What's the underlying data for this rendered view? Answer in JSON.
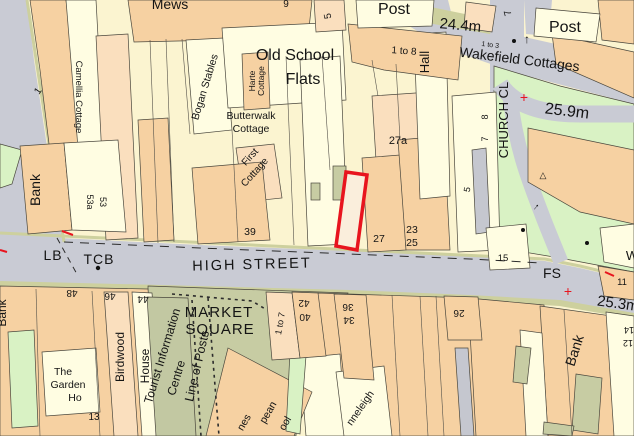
{
  "map": {
    "road_labels": {
      "high_street": "HIGH STREET",
      "church_close": "CHURCH CL"
    },
    "street_furniture": {
      "lb": "LB",
      "tcb": "TCB",
      "fs": "FS",
      "post_left": "Post",
      "post_right": "Post",
      "line_of_posts": "Line of Posts",
      "market_line1": "MARKET",
      "market_line2": "SQUARE"
    },
    "spot_heights": {
      "h244": "24.4m",
      "h259": "25.9m",
      "h253": "25.3m"
    },
    "buildings": {
      "mews": "Mews",
      "old_school_line1": "Old School",
      "old_school_line2": "Flats",
      "wakefield": "Wakefield Cottages",
      "hall": "Hall",
      "camellia": "Camellia Cottage",
      "bogan": "Bogan Stables",
      "harte_line1": "Harte",
      "harte_line2": "Cottage",
      "butterwalk_line1": "Butterwalk",
      "butterwalk_line2": "Cottage",
      "first_line1": "First",
      "first_line2": "Cottage",
      "bank_nw": "Bank",
      "bank_sw": "Bank",
      "bank_se": "Bank",
      "birdwood_line1": "Birdwood",
      "birdwood_line2": "House",
      "tic_line1": "Tourist Information",
      "tic_line2": "Centre",
      "garden_line1": "The",
      "garden_line2": "Garden",
      "garden_line3": "Ho",
      "anneleigh_partial": "nneleigh",
      "school_frag1": "nes",
      "school_frag2": "pean",
      "school_frag3": "ool",
      "w_partial": "W"
    },
    "numbers": {
      "n1": "1",
      "n5_top": "5",
      "n5_mid": "5",
      "n7_topright": "7",
      "n7": "7",
      "n8": "8",
      "n9": "9",
      "n11": "11",
      "n12": "12",
      "n13": "13",
      "n14": "14",
      "n15": "15",
      "n23": "23",
      "n25": "25",
      "n26": "26",
      "n27": "27",
      "n27a": "27a",
      "n34": "34",
      "n36": "36",
      "n39": "39",
      "n40": "40",
      "n42": "42",
      "n44": "44",
      "n46": "46",
      "n48": "48",
      "n53": "53",
      "n53a": "53a",
      "range_1to8_a": "1 to 8",
      "range_1to3": "1 to 3",
      "range_1to7": "1 to 7"
    },
    "markers": {
      "red_cross_a": "+",
      "red_cross_b": "+",
      "triangle": "△",
      "arrow_up": "↑",
      "arrow_ne": "↑"
    },
    "colors": {
      "base_cream": "#fbf4d0",
      "building_cream": "#fffde2",
      "building_peach": "#f6d1a2",
      "building_peach_light": "#fadfbe",
      "road_gray": "#c9cbd4",
      "building_gray": "#c5c7cf",
      "verge_olive": "#cdd09e",
      "open_sage": "#c7cca3",
      "open_green": "#d9f2c4",
      "plot_outline_red": "#e8141e"
    }
  }
}
